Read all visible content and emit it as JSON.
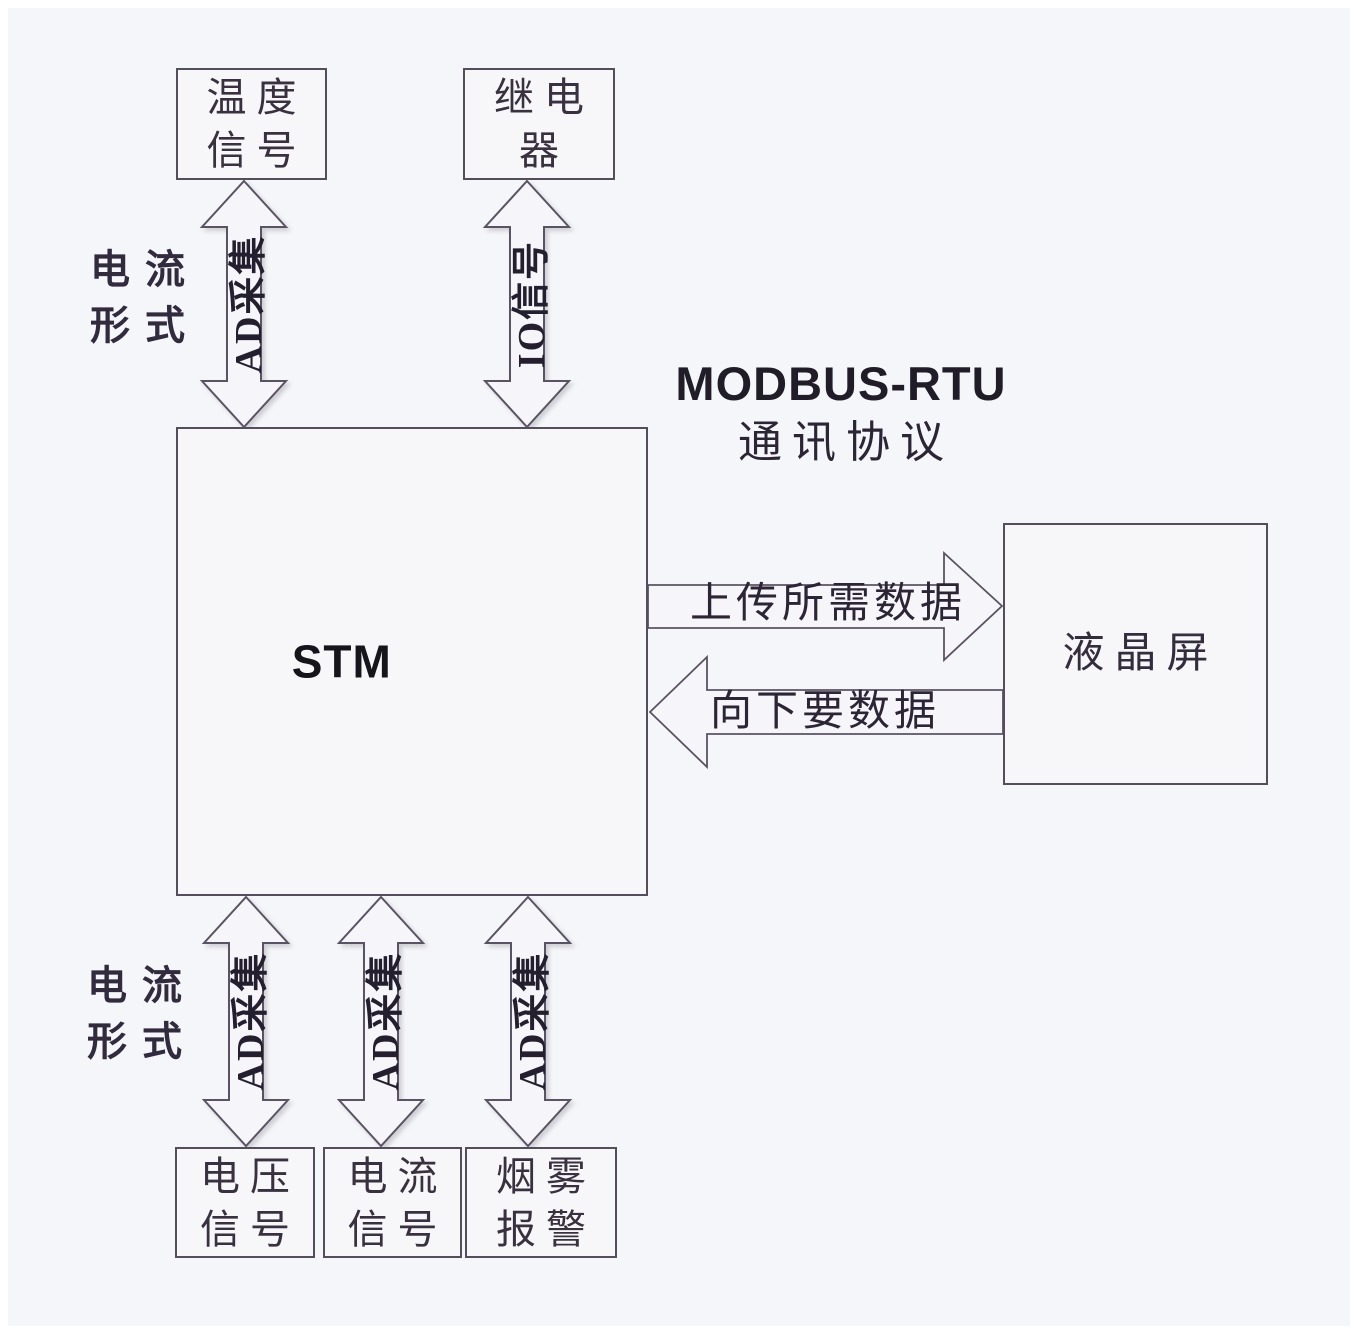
{
  "diagram": {
    "background": "#f5f6f9",
    "line_color": "#544e5c",
    "text_color": "#39313f",
    "boxes": {
      "temperature_signal": {
        "line1": "温度",
        "line2": "信号"
      },
      "relay": {
        "line1": "继电",
        "line2": "器"
      },
      "stm": {
        "label": "STM"
      },
      "lcd_screen": {
        "label": "液晶屏"
      },
      "voltage_signal": {
        "line1": "电压",
        "line2": "信号"
      },
      "current_signal": {
        "line1": "电流",
        "line2": "信号"
      },
      "smoke_alarm": {
        "line1": "烟雾",
        "line2": "报警"
      }
    },
    "arrows": {
      "ad_collect_temp": "AD采集",
      "io_signal": "IO信号",
      "upload_data": "上传所需数据",
      "request_data": "向下要数据",
      "ad_collect_voltage": "AD采集",
      "ad_collect_current": "AD采集",
      "ad_collect_smoke": "AD采集"
    },
    "annotations": {
      "current_form_top": {
        "line1": "电流",
        "line2": "形式"
      },
      "current_form_bottom": {
        "line1": "电流",
        "line2": "形式"
      },
      "modbus_protocol": {
        "line1": "MODBUS-RTU",
        "line2": "通讯协议"
      }
    }
  }
}
